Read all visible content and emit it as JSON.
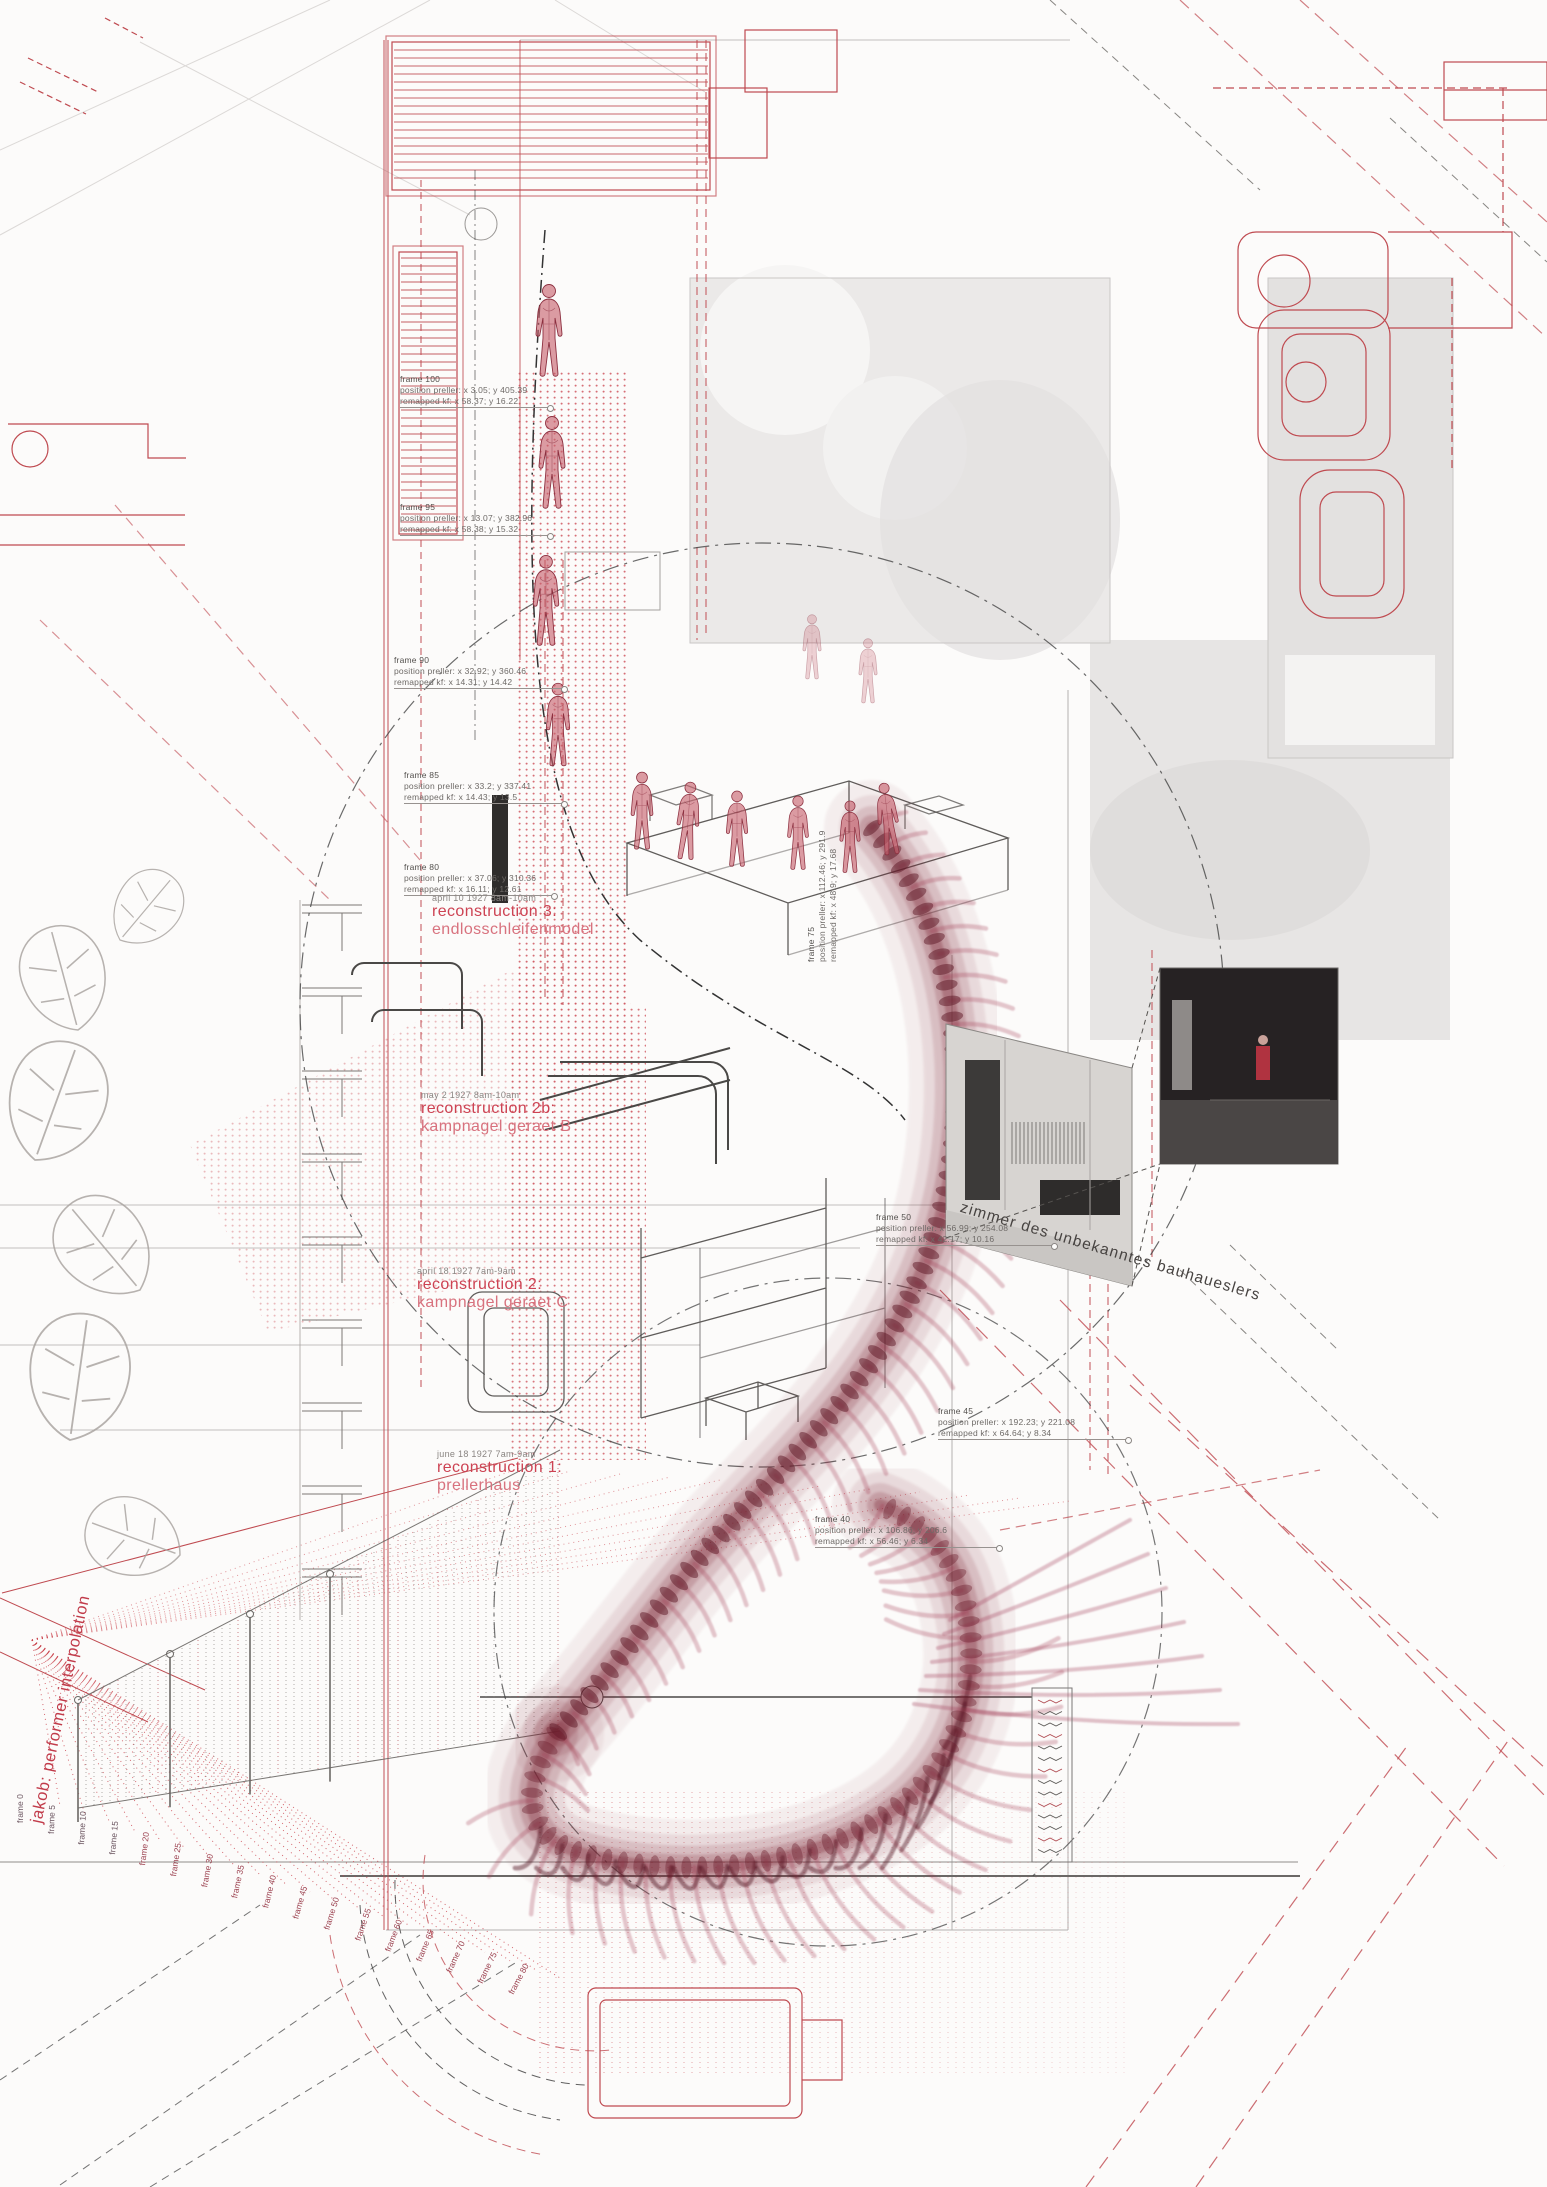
{
  "colors": {
    "red_line": "#bf4a50",
    "red_text": "#cd4353",
    "red_text_light": "#d8727e",
    "spine_maroon": "#6d1e2d",
    "ink": "#3c3a39",
    "annotation_gray": "#6e6a67",
    "photo_gray": "#e9e7e6"
  },
  "labels": {
    "jakob": {
      "text": "jakob: performer interpolation"
    },
    "zimmer": {
      "text": "zimmer des unbekanntes bauhaueslers"
    }
  },
  "frame_annotations": [
    {
      "label": "frame 100",
      "pos": "position preller: x 3.05; y 405.39",
      "remap": "remapped kf: x 58.37; y 16.22",
      "x": 400,
      "y": 374,
      "rot": 0,
      "leader": 148
    },
    {
      "label": "frame 95",
      "pos": "position preller: x 13.07; y 382.96",
      "remap": "remapped kf: x 58.38; y 15.32",
      "x": 400,
      "y": 502,
      "rot": 0,
      "leader": 148
    },
    {
      "label": "frame 90",
      "pos": "position preller: x 32.92; y 360.46",
      "remap": "remapped kf: x 14.31; y 14.42",
      "x": 394,
      "y": 655,
      "rot": 0,
      "leader": 168
    },
    {
      "label": "frame 85",
      "pos": "position preller: x 33.2; y 337.41",
      "remap": "remapped kf: x 14.43; y 13.5",
      "x": 404,
      "y": 770,
      "rot": 0,
      "leader": 158
    },
    {
      "label": "frame 80",
      "pos": "position preller: x 37.06; y 310.36",
      "remap": "remapped kf: x 16.11; y 12.61",
      "x": 404,
      "y": 862,
      "rot": 0,
      "leader": 148
    },
    {
      "label": "frame 75",
      "pos": "position preller: x 112.46; y 291.9",
      "remap": "remapped kf: x 48.9; y 17.68",
      "x": 806,
      "y": 962,
      "rot": -90,
      "leader": 0
    },
    {
      "label": "frame 50",
      "pos": "position preller: x 56.99; y 254.08",
      "remap": "remapped kf: x 42.17; y 10.16",
      "x": 876,
      "y": 1212,
      "rot": 0,
      "leader": 176
    },
    {
      "label": "frame 45",
      "pos": "position preller: x 192.23; y 221.08",
      "remap": "remapped kf: x 64.64; y 8.34",
      "x": 938,
      "y": 1406,
      "rot": 0,
      "leader": 188
    },
    {
      "label": "frame 40",
      "pos": "position preller: x 106.86; y 206.6",
      "remap": "remapped kf: x 56.46; y 6.34",
      "x": 815,
      "y": 1514,
      "rot": 0,
      "leader": 182
    }
  ],
  "reconstructions": [
    {
      "date": "april 10 1927 8am-10am",
      "title": "reconstruction 3:",
      "subtitle": "endlosschleifenmodel",
      "x": 432,
      "y": 893
    },
    {
      "date": "may 2 1927 8am-10am",
      "title": "reconstruction 2b:",
      "subtitle": "kampnagel geraet B",
      "x": 421,
      "y": 1090
    },
    {
      "date": "april 18 1927 7am-9am",
      "title": "reconstruction 2:",
      "subtitle": "kampnagel geraet C",
      "x": 417,
      "y": 1266
    },
    {
      "date": "june 18 1927 7am-9am",
      "title": "reconstruction 1:",
      "subtitle": "prellerhaus",
      "x": 437,
      "y": 1449
    }
  ],
  "fan_frame_labels": [
    "frame 0",
    "frame 5",
    "frame 10",
    "frame 15",
    "frame 20",
    "frame 25",
    "frame 30",
    "frame 35",
    "frame 40",
    "frame 45",
    "frame 50",
    "frame 55",
    "frame 60",
    "frame 65",
    "frame 70",
    "frame 75",
    "frame 80"
  ]
}
